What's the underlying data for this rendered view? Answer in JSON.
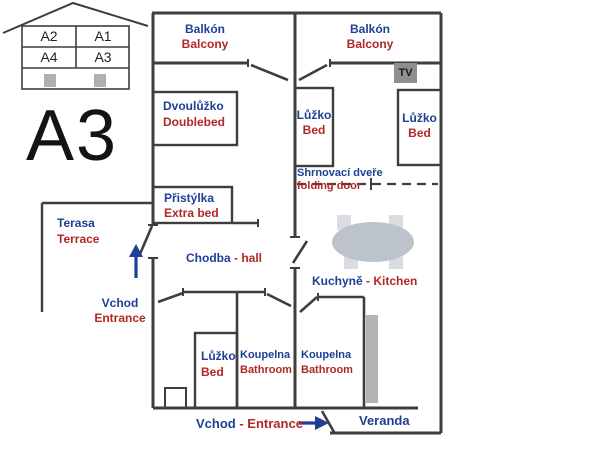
{
  "palette": {
    "label_blue": "#1f3f94",
    "label_red": "#b22727",
    "wall_gray": "#3e3e3e",
    "furniture_gray": "#bcc3ca",
    "chair_gray": "#d9dde1",
    "tv_gray": "#8f8f8f"
  },
  "legend_house": {
    "units": [
      "A2",
      "A1",
      "A4",
      "A3"
    ]
  },
  "apartment_label": "A3",
  "rooms": {
    "balcony_left": {
      "cz": "Balkón",
      "en": "Balcony"
    },
    "balcony_right": {
      "cz": "Balkón",
      "en": "Balcony"
    },
    "doublebed": {
      "cz": "Dvoulůžko",
      "en": "Doublebed"
    },
    "bed_right_1": {
      "cz": "Lůžko",
      "en": "Bed"
    },
    "bed_right_2": {
      "cz": "Lůžko",
      "en": "Bed"
    },
    "folding_door": {
      "cz": "Shrnovací dveře",
      "en": "folding door"
    },
    "extra_bed": {
      "cz": "Přistýlka",
      "en": "Extra bed"
    },
    "terrace": {
      "cz": "Terasa",
      "en": "Terrace"
    },
    "hall": {
      "cz": "Chodba",
      "sep": " - ",
      "en": "hall"
    },
    "entrance_side": {
      "cz": "Vchod",
      "en": "Entrance"
    },
    "kitchen": {
      "cz": "Kuchyně",
      "sep": " - ",
      "en": "Kitchen"
    },
    "bed_bottom": {
      "cz": "Lůžko",
      "en": "Bed"
    },
    "bathroom_1": {
      "cz": "Koupelna",
      "en": "Bathroom"
    },
    "bathroom_2": {
      "cz": "Koupelna",
      "en": "Bathroom"
    },
    "entrance_bottom": {
      "cz": "Vchod",
      "sep": " - ",
      "en": "Entrance"
    },
    "veranda": {
      "cz": "Veranda"
    },
    "tv": {
      "label": "TV"
    }
  }
}
